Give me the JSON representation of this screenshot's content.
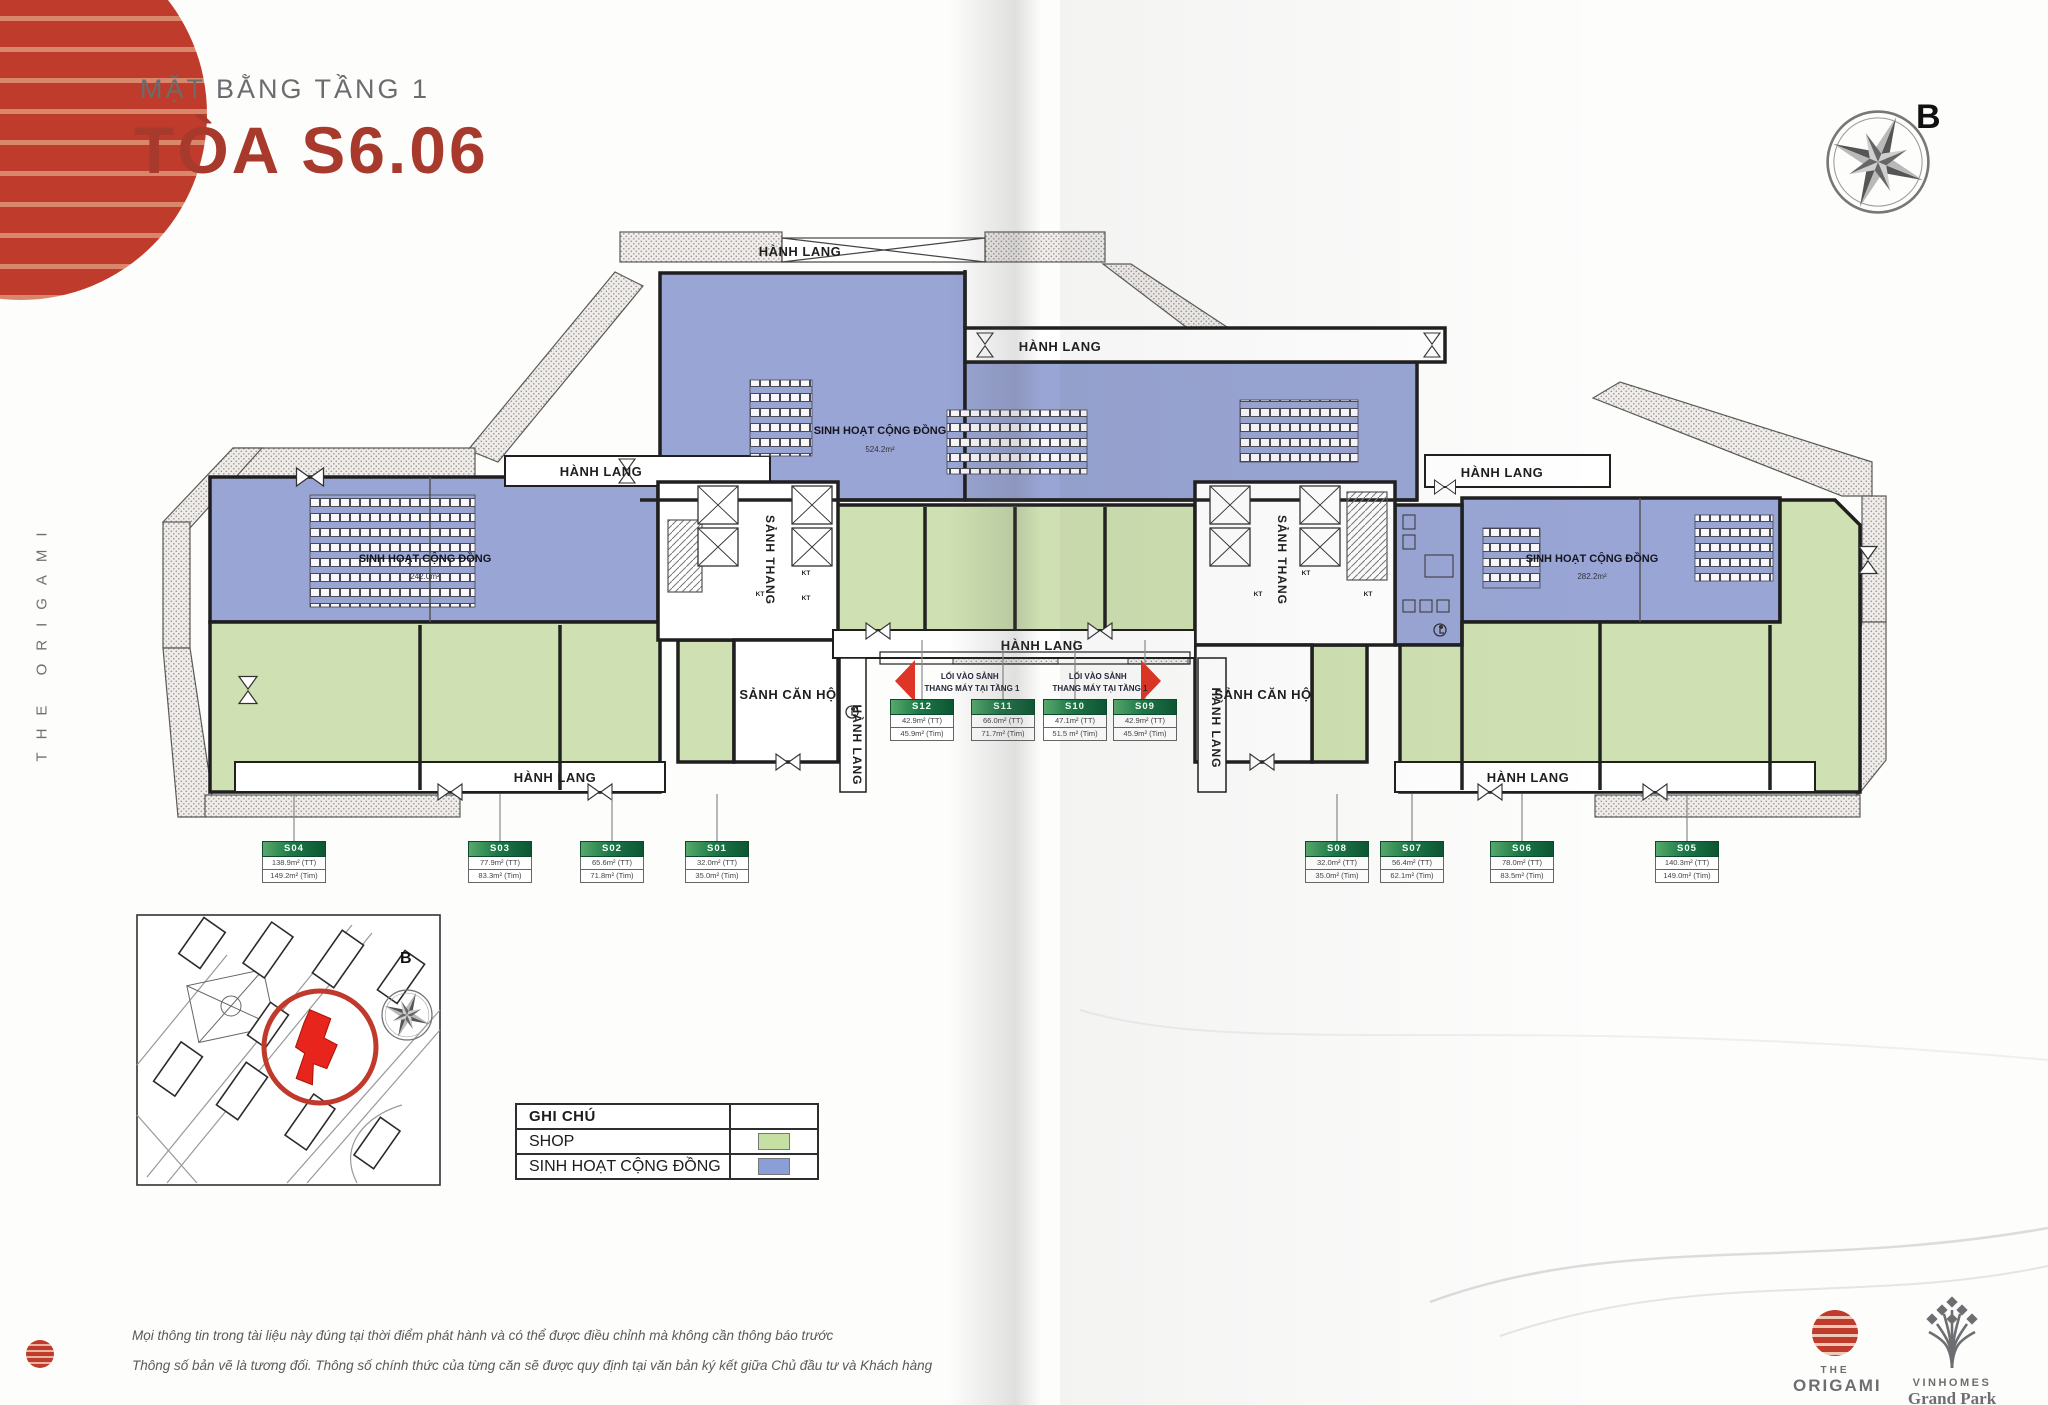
{
  "header": {
    "subtitle": "MẶT BẰNG TẦNG 1",
    "title": "TÒA S6.06"
  },
  "side_text": "THE ORIGAMI",
  "compass": {
    "label": "B"
  },
  "plan": {
    "labels": {
      "hanh_lang": "HÀNH LANG",
      "sanh_thang": "SẢNH THANG",
      "sanh_can_ho": "SẢNH CĂN HỘ",
      "kt": "KT",
      "community": "SINH HOẠT CỘNG ĐỒNG",
      "area_top": "524.2m²",
      "area_left": "242.0m²",
      "area_right": "282.2m²",
      "entrance_line1": "LỐI VÀO SẢNH",
      "entrance_line2": "THANG MÁY TẠI TẦNG 1"
    }
  },
  "units": [
    {
      "label": "S01",
      "tt": "32.0m² (TT)",
      "tim": "35.0m² (Tim)"
    },
    {
      "label": "S02",
      "tt": "65.6m² (TT)",
      "tim": "71.8m² (Tim)"
    },
    {
      "label": "S03",
      "tt": "77.9m² (TT)",
      "tim": "83.3m² (Tim)"
    },
    {
      "label": "S04",
      "tt": "138.9m² (TT)",
      "tim": "149.2m² (Tim)"
    },
    {
      "label": "S05",
      "tt": "140.3m² (TT)",
      "tim": "149.0m² (Tim)"
    },
    {
      "label": "S06",
      "tt": "78.0m² (TT)",
      "tim": "83.5m² (Tim)"
    },
    {
      "label": "S07",
      "tt": "56.4m² (TT)",
      "tim": "62.1m² (Tim)"
    },
    {
      "label": "S08",
      "tt": "32.0m² (TT)",
      "tim": "35.0m² (Tim)"
    },
    {
      "label": "S09",
      "tt": "42.9m² (TT)",
      "tim": "45.9m² (Tim)"
    },
    {
      "label": "S10",
      "tt": "47.1m² (TT)",
      "tim": "51.5 m² (Tim)"
    },
    {
      "label": "S11",
      "tt": "66.0m² (TT)",
      "tim": "71.7m² (Tim)"
    },
    {
      "label": "S12",
      "tt": "42.9m² (TT)",
      "tim": "45.9m² (Tim)"
    }
  ],
  "legend": {
    "title": "GHI CHÚ",
    "items": [
      {
        "label": "SHOP",
        "color": "#c6dfa2"
      },
      {
        "label": "SINH HOẠT CỘNG ĐỒNG",
        "color": "#8c9ed7"
      }
    ]
  },
  "footer": {
    "line1": "Mọi thông tin trong tài liệu này đúng tại thời điểm phát hành và có thể được điều chỉnh mà không cần thông báo trước",
    "line2": "Thông số bản vẽ là tương đối. Thông số chính thức của từng căn sẽ được quy định tại văn bản ký kết giữa Chủ đầu tư và Khách hàng",
    "origami_top": "THE",
    "origami_bottom": "ORIGAMI",
    "vinhomes_top": "VINHOMES",
    "vinhomes_bottom": "Grand Park"
  },
  "colors": {
    "accent": "#a73a2d",
    "shop": "#cfe1b2",
    "community": "#99a5d4",
    "highlight_red": "#e8251c"
  }
}
